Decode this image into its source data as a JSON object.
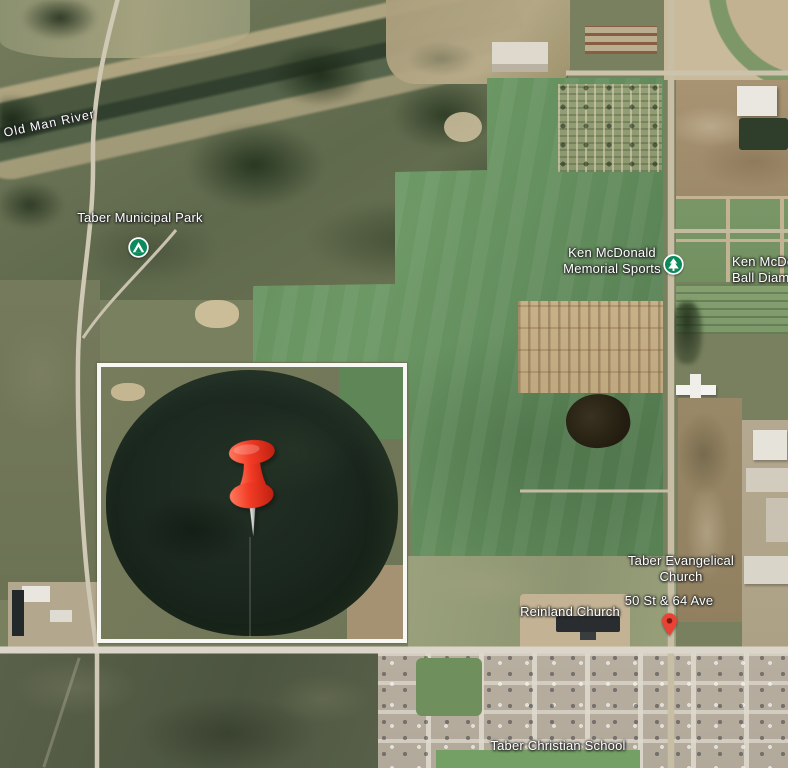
{
  "labels": {
    "river": "Old Man River",
    "municipal_park": "Taber Municipal Park",
    "sports1": "Ken McDonald",
    "sports2": "Memorial Sports",
    "ball1": "Ken McDonald",
    "ball2": "Ball Diamond",
    "evangelical1": "Taber Evangelical",
    "evangelical2": "Church",
    "street": "50 St & 64 Ave",
    "reinland": "Reinland Church",
    "school": "Taber Christian School"
  },
  "markers": {
    "pushpin": "red-pushpin",
    "poi_marker": "red-map-marker",
    "campground": "campground-icon",
    "park": "park-tree-icon"
  },
  "colors": {
    "poi_green": "#0c8a5c",
    "pushpin_red": "#f23b25",
    "marker_red": "#e94335",
    "parcel_outline": "#fcfcfa"
  }
}
